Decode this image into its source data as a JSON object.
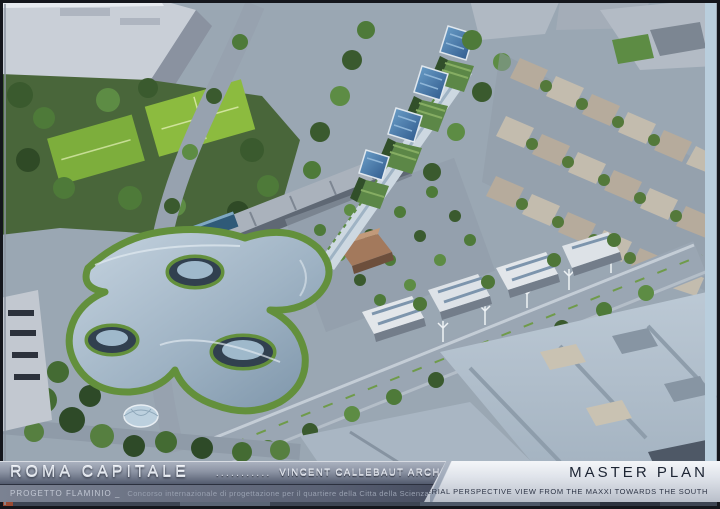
{
  "banner": {
    "title": "ROMA CAPITALE",
    "title_separator_dots": "...........",
    "architect": "VINCENT CALLEBAUT ARCHITECTURES",
    "project_label": "PROGETTO FLAMINIO _",
    "project_subtitle": "Concorso internazionale di progettazione per il quartiere della Citta della Scienza",
    "plan_title": "MASTER PLAN",
    "plan_caption": "AERIAL PERSPECTIVE VIEW FROM THE MAXXI TOWARDS THE SOUTH"
  },
  "colors": {
    "banner_metal_band": "#8b93a3",
    "banner_sub_band": "#5a6174",
    "panel_light": "#eef1f5",
    "chrome_text": "#dde2ea",
    "master_plan_text": "#1c2433",
    "vegetation_green": "#4a6b38",
    "sports_field_green": "#8cbb3f",
    "solar_roof_blue": "#35639a",
    "sinuous_roof_blue": "#9fb3c4",
    "industrial_roof": "#b7c4d0",
    "street_gray": "#9aa6b3"
  }
}
